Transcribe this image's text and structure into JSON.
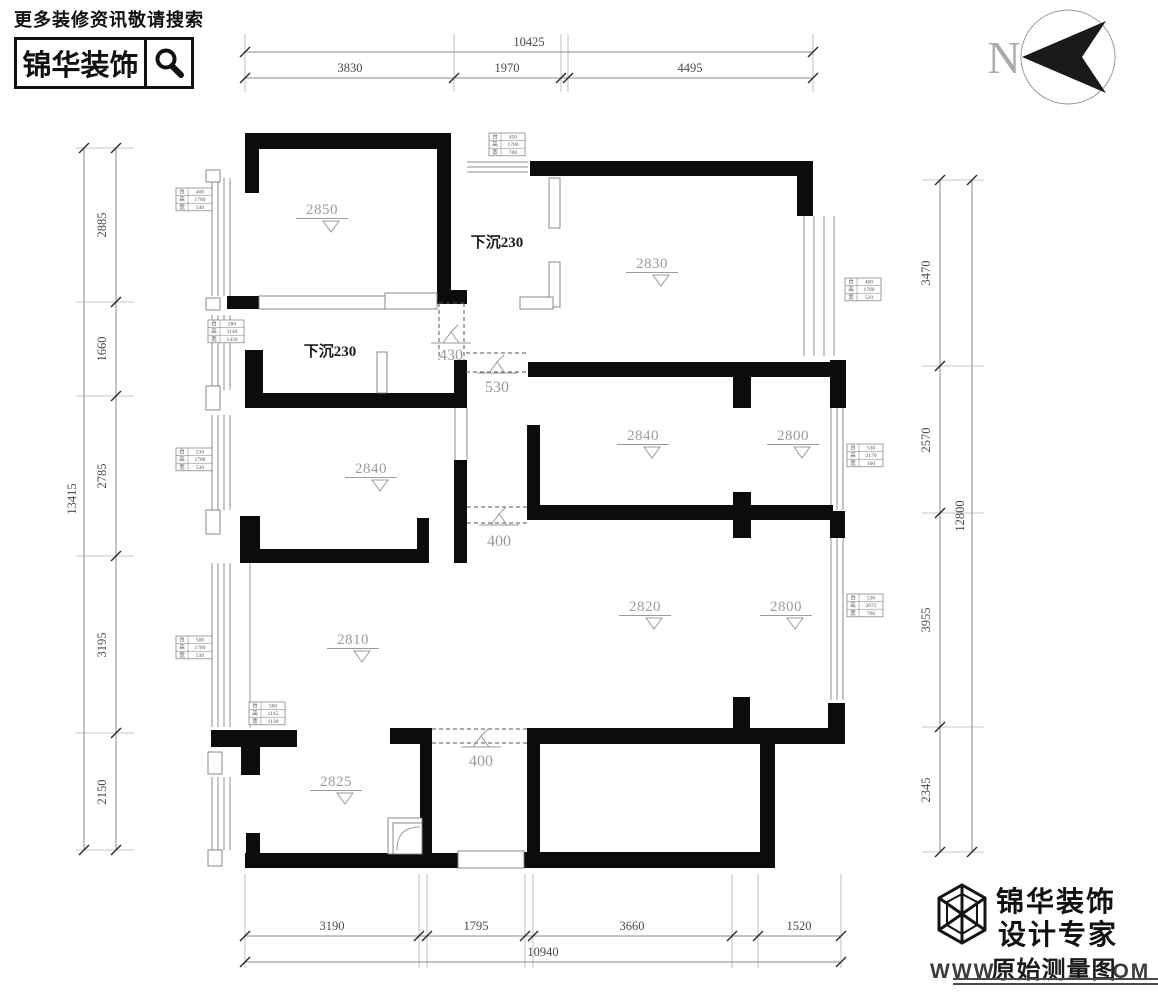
{
  "header": {
    "hint": "更多装修资讯敬请搜索",
    "brand": "锦华装饰"
  },
  "compass": {
    "label": "N",
    "cx": 1068,
    "cy": 57,
    "r": 47
  },
  "room_labels": [
    {
      "text": "2850",
      "x": 322,
      "y": 214
    },
    {
      "text": "2830",
      "x": 652,
      "y": 268
    },
    {
      "text": "2840",
      "x": 371,
      "y": 473
    },
    {
      "text": "2840",
      "x": 643,
      "y": 440
    },
    {
      "text": "2800",
      "x": 793,
      "y": 440
    },
    {
      "text": "2820",
      "x": 645,
      "y": 611
    },
    {
      "text": "2800",
      "x": 786,
      "y": 611
    },
    {
      "text": "2810",
      "x": 353,
      "y": 644
    },
    {
      "text": "2825",
      "x": 336,
      "y": 786
    }
  ],
  "sunken_labels": [
    {
      "text": "下沉230",
      "x": 497,
      "y": 247
    },
    {
      "text": "下沉230",
      "x": 330,
      "y": 356
    }
  ],
  "openings": [
    {
      "label": "430",
      "lx": 451,
      "ly": 360,
      "sym": [
        451,
        336
      ],
      "dir": "v",
      "a": 439,
      "b": 464,
      "from": 303,
      "to": 360
    },
    {
      "label": "530",
      "lx": 497,
      "ly": 392,
      "sym": [
        497,
        366
      ],
      "dir": "h",
      "a": 353,
      "b": 372,
      "from": 466,
      "to": 528
    },
    {
      "label": "400",
      "lx": 499,
      "ly": 546,
      "sym": [
        499,
        518
      ],
      "dir": "h",
      "a": 507,
      "b": 523,
      "from": 467,
      "to": 527
    },
    {
      "label": "400",
      "lx": 481,
      "ly": 766,
      "sym": [
        481,
        740
      ],
      "dir": "h",
      "a": 729,
      "b": 743,
      "from": 432,
      "to": 527
    }
  ],
  "window_tables": [
    {
      "x": 176,
      "y": 188,
      "rows": [
        [
          "台",
          "400"
        ],
        [
          "高",
          "1780"
        ],
        [
          "宽",
          "540"
        ]
      ]
    },
    {
      "x": 208,
      "y": 320,
      "rows": [
        [
          "台",
          "280"
        ],
        [
          "高",
          "1140"
        ],
        [
          "宽",
          "1430"
        ]
      ]
    },
    {
      "x": 176,
      "y": 448,
      "rows": [
        [
          "台",
          "530"
        ],
        [
          "高",
          "1780"
        ],
        [
          "宽",
          "530"
        ]
      ]
    },
    {
      "x": 176,
      "y": 636,
      "rows": [
        [
          "台",
          "500"
        ],
        [
          "高",
          "1780"
        ],
        [
          "宽",
          "530"
        ]
      ]
    },
    {
      "x": 489,
      "y": 133,
      "rows": [
        [
          "台",
          "450"
        ],
        [
          "高",
          "1700"
        ],
        [
          "宽",
          "700"
        ]
      ]
    },
    {
      "x": 845,
      "y": 278,
      "rows": [
        [
          "台",
          "400"
        ],
        [
          "高",
          "1780"
        ],
        [
          "宽",
          "520"
        ]
      ]
    },
    {
      "x": 847,
      "y": 444,
      "rows": [
        [
          "台",
          "530"
        ],
        [
          "高",
          "2170"
        ],
        [
          "宽",
          "100"
        ]
      ]
    },
    {
      "x": 847,
      "y": 594,
      "rows": [
        [
          "台",
          "530"
        ],
        [
          "高",
          "2075"
        ],
        [
          "宽",
          "700"
        ]
      ]
    },
    {
      "x": 249,
      "y": 702,
      "rows": [
        [
          "台",
          "560"
        ],
        [
          "高",
          "1145"
        ],
        [
          "宽",
          "1130"
        ]
      ]
    }
  ],
  "dims": {
    "top": {
      "overall": {
        "text": "10425",
        "y": 52,
        "x1": 245,
        "x2": 813,
        "lx": 529
      },
      "seg": {
        "y": 78,
        "ticks": [
          245,
          454,
          561,
          568,
          813
        ],
        "labels": [
          {
            "t": "3830",
            "x": 350
          },
          {
            "t": "1970",
            "x": 507
          },
          {
            "t": "4495",
            "x": 690
          }
        ]
      },
      "ext": [
        34,
        92
      ]
    },
    "bottom": {
      "overall": {
        "text": "10940",
        "y": 962,
        "x1": 245,
        "x2": 841,
        "lx": 543
      },
      "seg": {
        "y": 936,
        "ticks": [
          245,
          419,
          427,
          525,
          533,
          732,
          758,
          841
        ],
        "labels": [
          {
            "t": "3190",
            "x": 332
          },
          {
            "t": "1795",
            "x": 476
          },
          {
            "t": "3660",
            "x": 632
          },
          {
            "t": "1520",
            "x": 799
          }
        ]
      },
      "ext": [
        874,
        968
      ]
    },
    "left": {
      "overall": {
        "text": "13415",
        "x": 84,
        "y1": 148,
        "y2": 850,
        "ly": 499
      },
      "seg": {
        "x": 116,
        "ticks": [
          148,
          302,
          396,
          556,
          733,
          850
        ],
        "labels": [
          {
            "t": "2885",
            "y": 225
          },
          {
            "t": "1660",
            "y": 349
          },
          {
            "t": "2785",
            "y": 476
          },
          {
            "t": "3195",
            "y": 645
          },
          {
            "t": "2150",
            "y": 792
          }
        ]
      },
      "ext": [
        76,
        134
      ]
    },
    "right": {
      "overall": {
        "text": "12800",
        "x": 972,
        "y1": 180,
        "y2": 852,
        "ly": 516
      },
      "seg": {
        "x": 940,
        "ticks": [
          180,
          366,
          513,
          727,
          852
        ],
        "labels": [
          {
            "t": "3470",
            "y": 273
          },
          {
            "t": "2570",
            "y": 440
          },
          {
            "t": "3955",
            "y": 620
          },
          {
            "t": "2345",
            "y": 790
          }
        ]
      },
      "ext": [
        922,
        984
      ]
    }
  },
  "logo": {
    "line1": "锦华装饰",
    "line2": "设计专家",
    "watermark": {
      "prefix": "WWW",
      "overlay": "原始测量图",
      "suffix": "OM"
    }
  }
}
